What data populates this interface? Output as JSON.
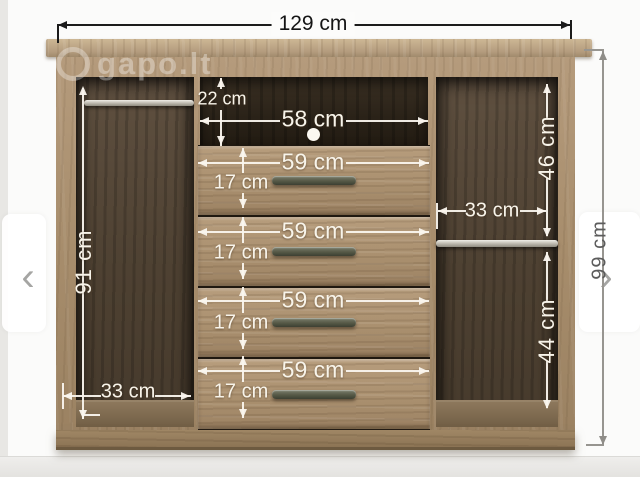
{
  "viewer": {
    "watermark": "gapo.lt",
    "prev_icon_glyph": "‹",
    "next_icon_glyph": "›"
  },
  "diagram": {
    "overall_width": "129 cm",
    "overall_height": "99 cm",
    "left_compartment": {
      "height": "91 cm",
      "width": "33 cm"
    },
    "top_shelf": {
      "height": "22 cm",
      "niche_width": "58 cm"
    },
    "drawers": [
      {
        "width": "59 cm",
        "height": "17 cm"
      },
      {
        "width": "59 cm",
        "height": "17 cm"
      },
      {
        "width": "59 cm",
        "height": "17 cm"
      },
      {
        "width": "59 cm",
        "height": "17 cm"
      }
    ],
    "right_compartment": {
      "upper_height": "46 cm",
      "width": "33 cm",
      "lower_height": "44 cm"
    }
  },
  "colors": {
    "wood_light": "#b49a7c",
    "wood_interior_dark": "#4e4132",
    "dimension_white": "#f8f4ea",
    "dimension_black": "#1b1b1b",
    "dimension_gray": "#5c5c5c"
  }
}
